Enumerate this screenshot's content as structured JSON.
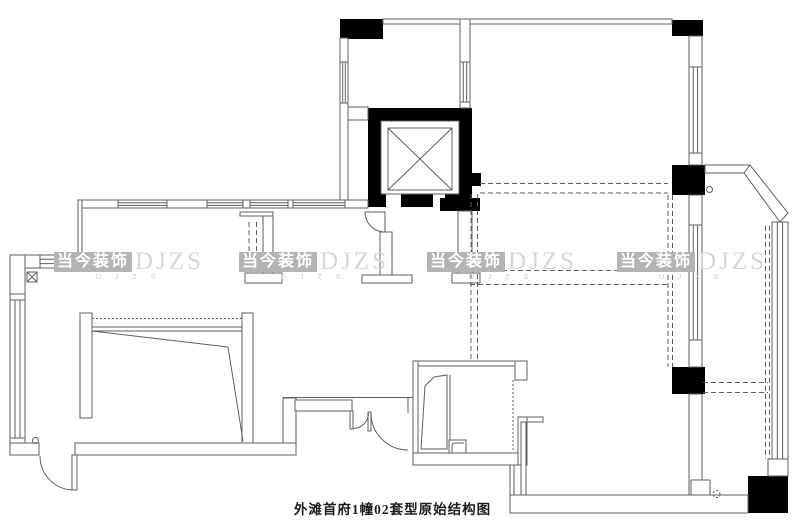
{
  "drawing": {
    "caption": "外滩首府1幢02套型原始结构图"
  },
  "watermark": {
    "brand": "当今装饰",
    "abbr": "DJZS",
    "sub": "D J Z S"
  },
  "colors": {
    "line": "#5f5f5f",
    "black": "#000000",
    "badge": "#b4b4b4",
    "badge-text": "#ffffff",
    "abbr": "#d7d7d7",
    "sub": "#cccccc",
    "caption": "#1c1c1c",
    "bg": "#ffffff"
  }
}
